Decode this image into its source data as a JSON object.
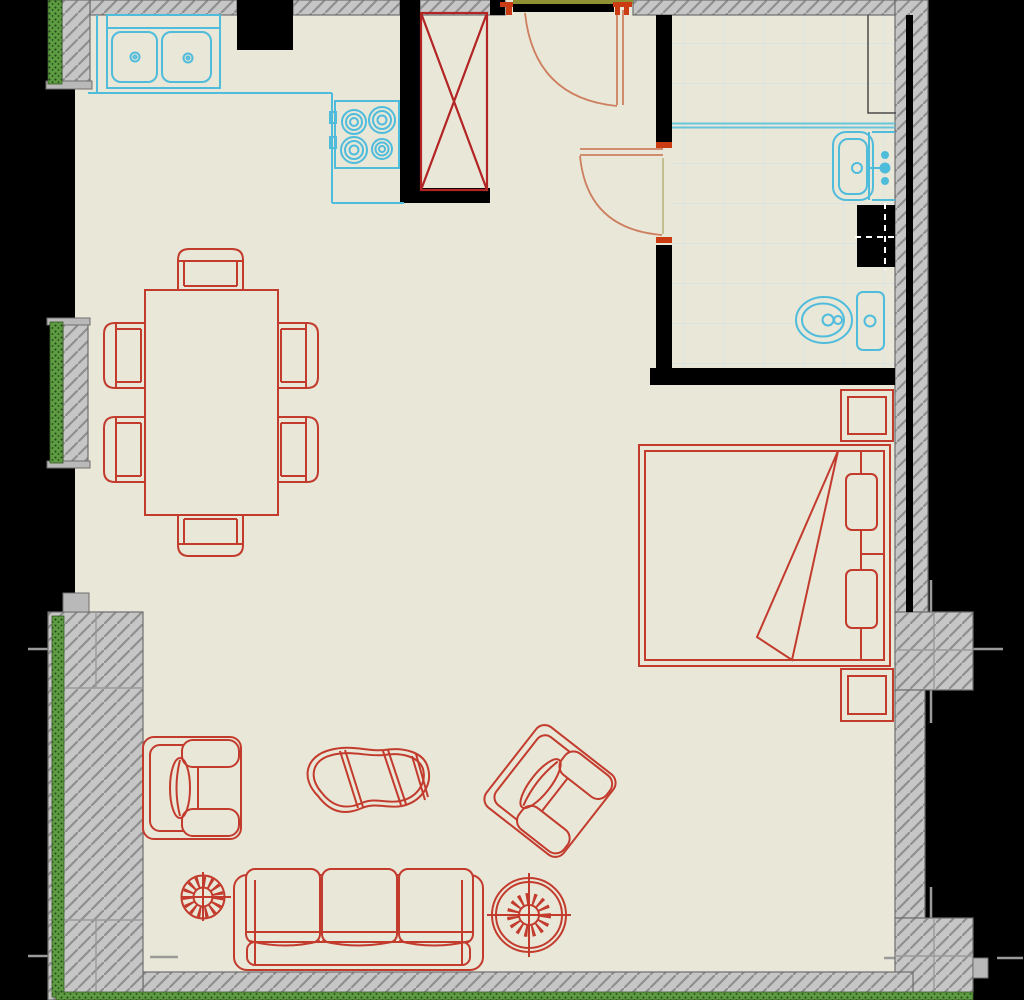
{
  "title": "apartment-floor-plan",
  "colors": {
    "outside": "#000000",
    "floor": "#e9e7d8",
    "wall_fill": "#c6c6c6",
    "wall_hatch": "#8f8f8f",
    "wall_border": "#6e6e6e",
    "wall_black": "#000000",
    "window_green": "#5d9c40",
    "window_green_dot": "#22421a",
    "tile_line": "#d9e1e7",
    "fixture_cyan": "#4fbcdc",
    "fixture_cyan_soft": "#66c6dd",
    "furniture_red": "#c23b2d",
    "furniture_dark_red": "#b32424",
    "door_salmon": "#cd7f5f",
    "door_jamb_orange": "#cc3c12",
    "threshold_olive": "#8f8f33",
    "dim_tick_gray": "#9a9a9a",
    "shaft_cross_white": "#ffffff",
    "shower_corner_line": "#4a4a4a"
  },
  "plan": {
    "rooms_implied": [
      "kitchen-living-area",
      "entry-hall",
      "bathroom",
      "sleeping-area"
    ],
    "fixtures": [
      "kitchen-double-sink",
      "kitchen-counter",
      "stove-cooktop",
      "wardrobe-closet",
      "entry-door",
      "bathroom-door",
      "shower-area",
      "bathroom-sink",
      "plumbing-shaft",
      "toilet",
      "bed",
      "nightstand-top",
      "nightstand-bottom",
      "dining-table",
      "dining-chairs-x6",
      "armchair-left",
      "armchair-rotated",
      "coffee-table",
      "potted-plant-small",
      "potted-plant-large",
      "sofa-three-seat"
    ],
    "windows": [
      "window-left-top",
      "window-left-middle",
      "window-left-lower-wall",
      "window-bottom-wall"
    ],
    "doors": [
      "entry-door-swing",
      "bathroom-door-swing"
    ]
  }
}
